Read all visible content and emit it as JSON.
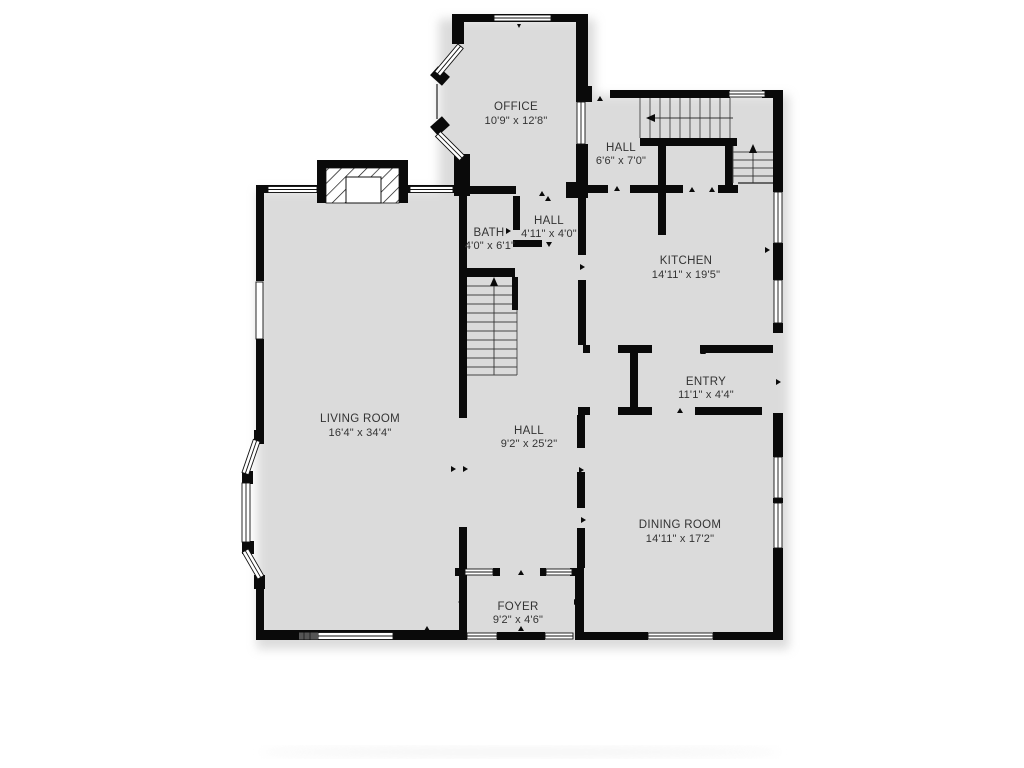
{
  "plan": {
    "wall_color": "#0a0a0a",
    "text_color": "#333333",
    "shadow_color": "#b8b8b8",
    "rooms": [
      {
        "id": "office",
        "name": "OFFICE",
        "dims": "10'9\" x 12'8\""
      },
      {
        "id": "hall-upper",
        "name": "HALL",
        "dims": "6'6\" x 7'0\""
      },
      {
        "id": "bath",
        "name": "BATH",
        "dims": "4'0\" x 6'1\""
      },
      {
        "id": "hall-mid",
        "name": "HALL",
        "dims": "4'11\" x 4'0\""
      },
      {
        "id": "kitchen",
        "name": "KITCHEN",
        "dims": "14'11\" x 19'5\""
      },
      {
        "id": "entry",
        "name": "ENTRY",
        "dims": "11'1\" x 4'4\""
      },
      {
        "id": "living-room",
        "name": "LIVING ROOM",
        "dims": "16'4\" x 34'4\""
      },
      {
        "id": "hall-lower",
        "name": "HALL",
        "dims": "9'2\" x 25'2\""
      },
      {
        "id": "dining-room",
        "name": "DINING ROOM",
        "dims": "14'11\" x 17'2\""
      },
      {
        "id": "foyer",
        "name": "FOYER",
        "dims": "9'2\" x 4'6\""
      }
    ]
  }
}
